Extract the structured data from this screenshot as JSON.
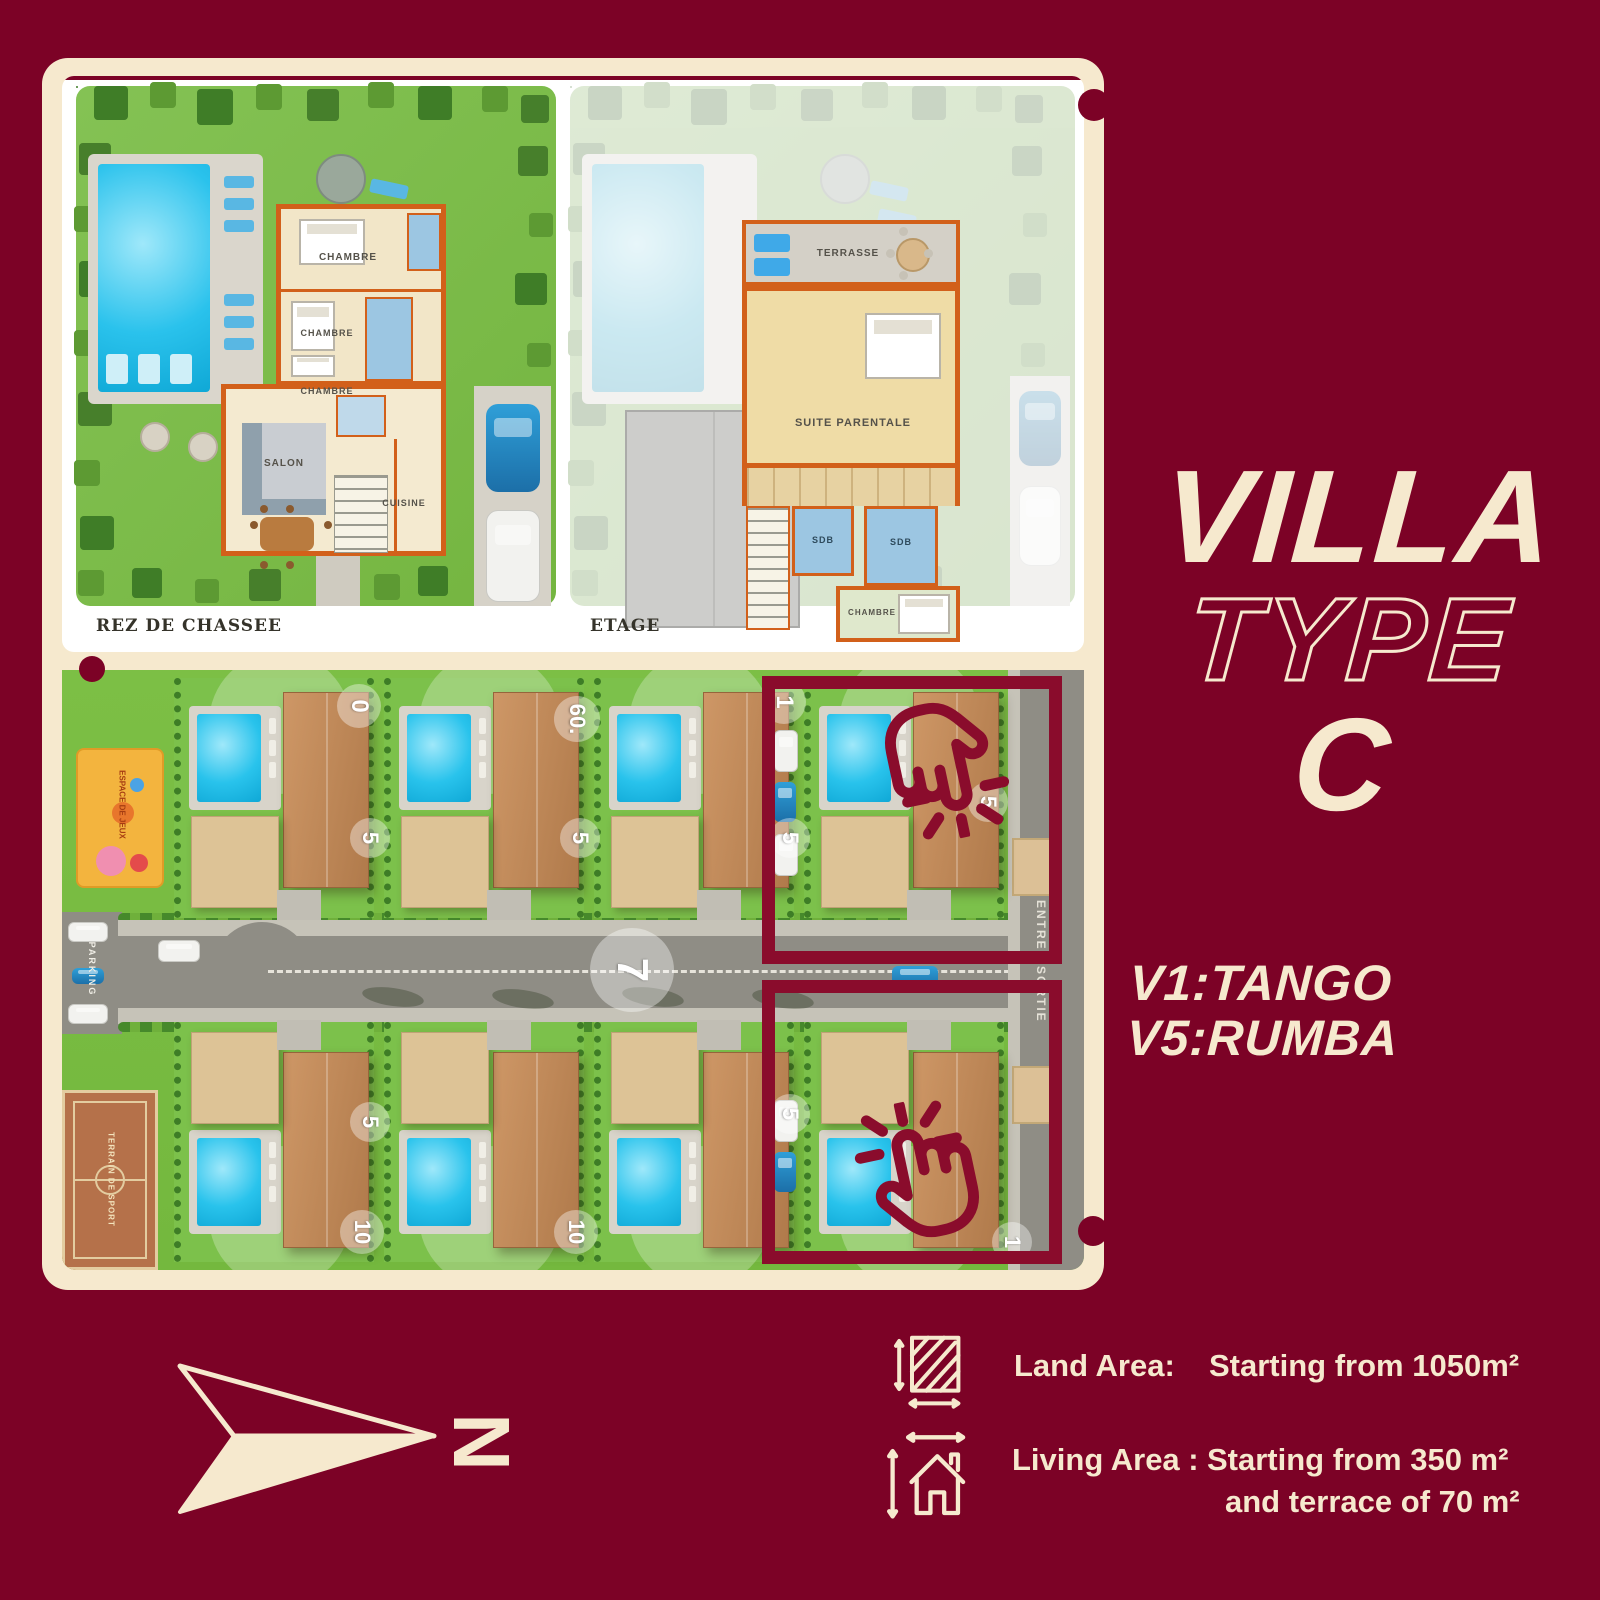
{
  "colors": {
    "background": "#7C0226",
    "accent": "#8A0C2C",
    "cream": "#F6E9CE",
    "grass": "#7CBF45",
    "pool": "#29C3EC",
    "roof": "#C08A5A",
    "road": "#8F8D85"
  },
  "title": {
    "line1": "VILLA",
    "line2": "TYPE",
    "line3": "C"
  },
  "callouts": {
    "v1": "V1:TANGO",
    "v5": "V5:RUMBA"
  },
  "specs": {
    "land": {
      "label": "Land Area:",
      "value": "Starting from  1050m²"
    },
    "living": {
      "label": "Living Area :",
      "value": "Starting from  350 m²",
      "value2": "and terrace of 70 m²"
    }
  },
  "compass": {
    "letter": "N"
  },
  "plans": {
    "ground": {
      "caption": "REZ DE CHASSEE",
      "rooms": {
        "chambre1": "CHAMBRE",
        "chambre2": "CHAMBRE",
        "chambre3": "CHAMBRE",
        "salon": "SALON",
        "cuisine": "CUISINE"
      }
    },
    "upper": {
      "caption": "ETAGE",
      "rooms": {
        "terrasse": "TERRASSE",
        "suite": "SUITE PARENTALE",
        "sdb1": "SDB",
        "sdb2": "SDB",
        "chambre": "CHAMBRE"
      }
    }
  },
  "site": {
    "entrance": "ENTREE/SORTIE",
    "parking": "PARKING",
    "court": "TERRAIN DE SPORT",
    "playground": "ESPACE DE JEUX",
    "badges": [
      "0",
      "60.",
      "1",
      "5",
      "5",
      "5",
      "5",
      "7",
      "5",
      "5",
      "10",
      "10",
      "1"
    ]
  }
}
